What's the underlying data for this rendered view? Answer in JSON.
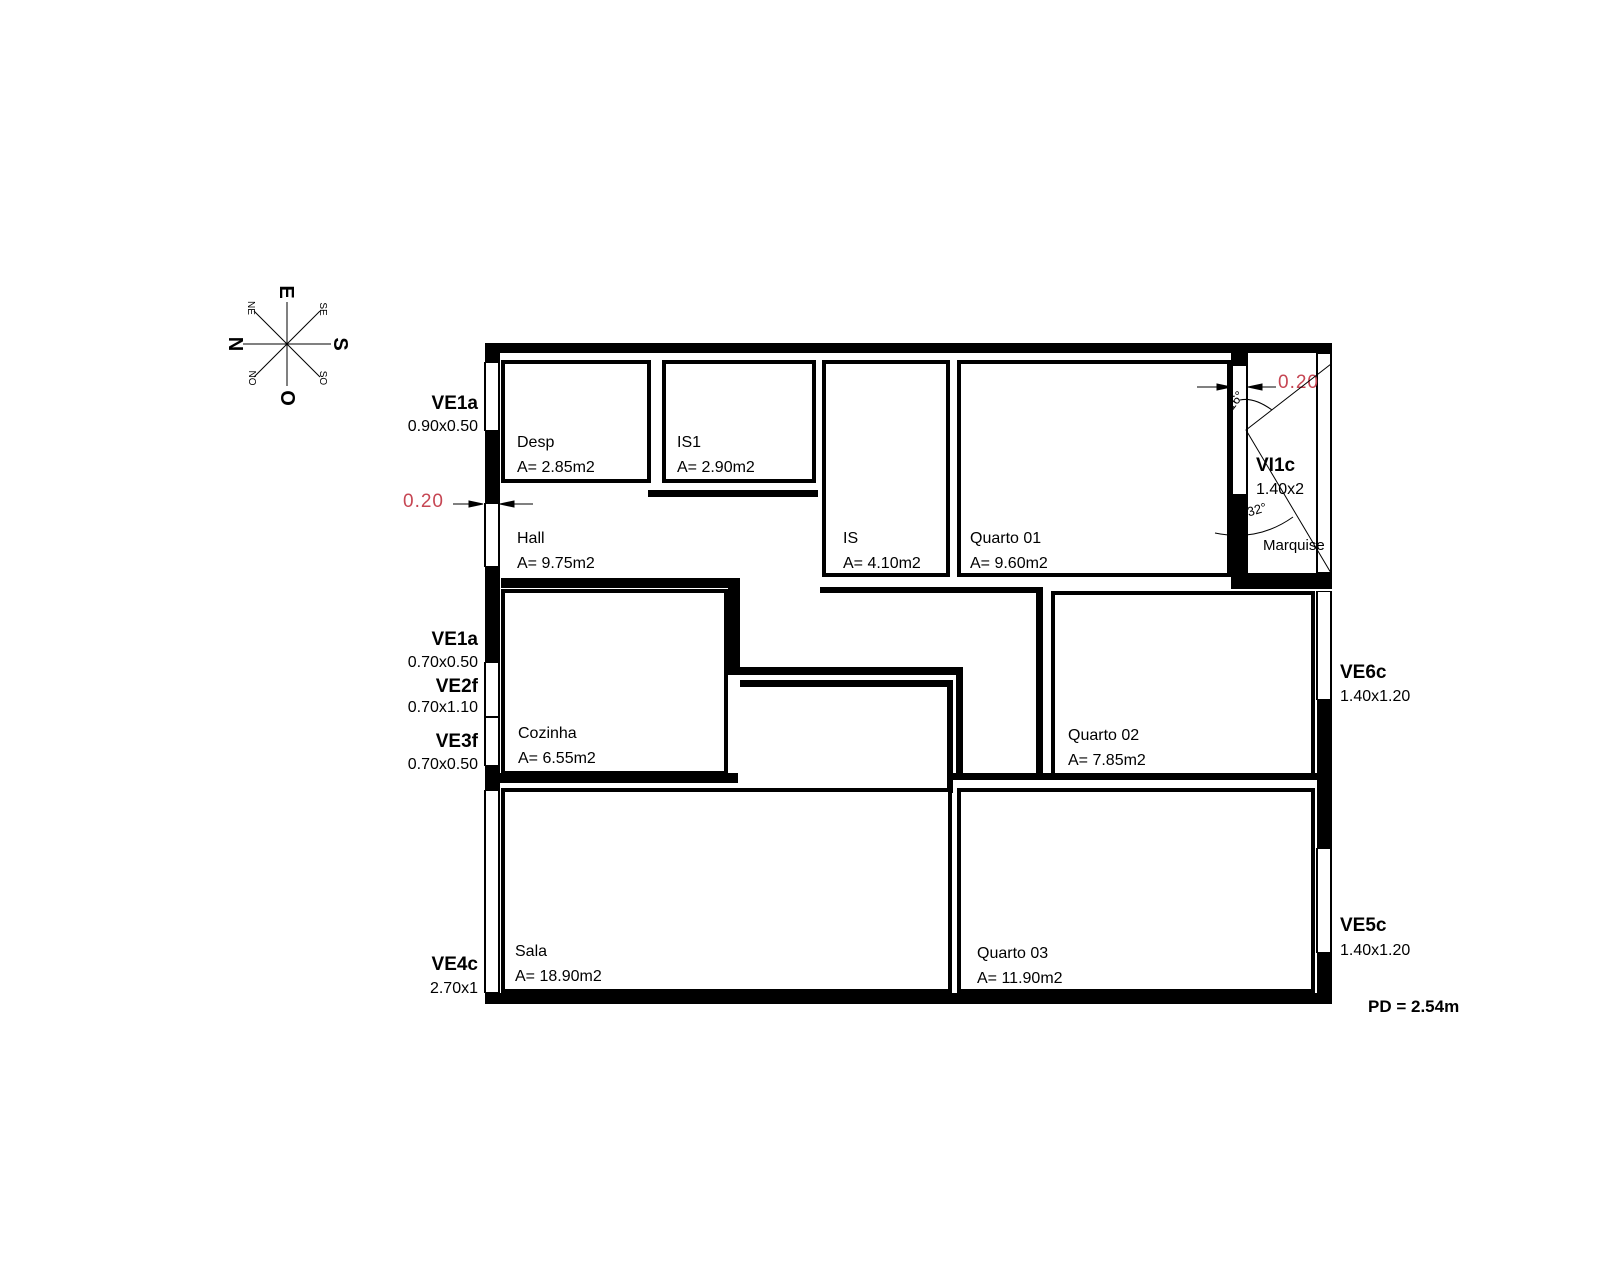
{
  "plan": {
    "compass": {
      "n": "N",
      "e": "E",
      "s": "S",
      "o": "O",
      "ne": "NE",
      "se": "SE",
      "no": "NO",
      "so": "SO"
    },
    "rooms": {
      "desp": {
        "name": "Desp",
        "area": "A= 2.85m2"
      },
      "is1": {
        "name": "IS1",
        "area": "A= 2.90m2"
      },
      "hall": {
        "name": "Hall",
        "area": "A= 9.75m2"
      },
      "is": {
        "name": "IS",
        "area": "A= 4.10m2"
      },
      "quarto01": {
        "name": "Quarto 01",
        "area": "A= 9.60m2"
      },
      "cozinha": {
        "name": "Cozinha",
        "area": "A= 6.55m2"
      },
      "quarto02": {
        "name": "Quarto 02",
        "area": "A= 7.85m2"
      },
      "sala": {
        "name": "Sala",
        "area": "A= 18.90m2"
      },
      "quarto03": {
        "name": "Quarto 03",
        "area": "A= 11.90m2"
      },
      "marquise": {
        "name": "Marquise"
      }
    },
    "openings": {
      "ve1a_top": {
        "code": "VE1a",
        "size": "0.90x0.50"
      },
      "ve1a_mid": {
        "code": "VE1a",
        "size": "0.70x0.50"
      },
      "ve2f": {
        "code": "VE2f",
        "size": "0.70x1.10"
      },
      "ve3f": {
        "code": "VE3f",
        "size": "0.70x0.50"
      },
      "ve4c": {
        "code": "VE4c",
        "size": "2.70x1"
      },
      "ve5c": {
        "code": "VE5c",
        "size": "1.40x1.20"
      },
      "ve6c": {
        "code": "VE6c",
        "size": "1.40x1.20"
      },
      "vi1c": {
        "code": "VI1c",
        "size": "1.40x2"
      }
    },
    "dimensions": {
      "wall_thickness_left": "0.20",
      "wall_thickness_right": "0.20",
      "ceiling_height": "PD = 2.54m"
    },
    "angles": {
      "upper": "16°",
      "lower": "32°"
    },
    "colors": {
      "dimension_red": "#c64653",
      "line": "#000000"
    }
  }
}
